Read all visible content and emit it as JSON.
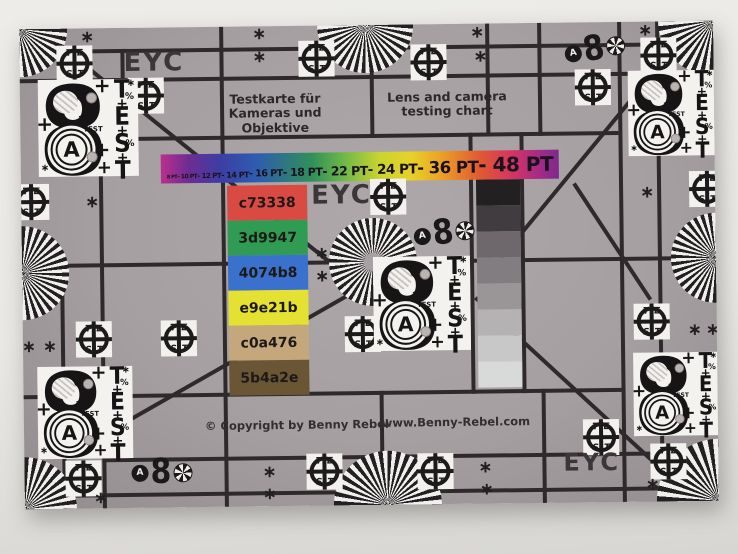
{
  "card": {
    "eyc_label": "EYC",
    "title_de_line1": "Testkarte für",
    "title_de_line2": "Kameras und Objektive",
    "title_en_line1": "Lens and camera",
    "title_en_line2": "testing chart",
    "copyright": "© Copyright by Benny Rebel",
    "website": "www.Benny-Rebel.com"
  },
  "pt_bar": {
    "tokens": [
      "8 PT",
      "- 10 PT",
      "- 12 PT",
      "- 14 PT",
      "- 16 PT",
      "- 18 PT",
      "- 22 PT",
      "- 24 PT",
      "- 36 PT",
      "- 48 PT"
    ]
  },
  "color_patches": [
    {
      "label": "c73338",
      "color": "#d94a43"
    },
    {
      "label": "3d9947",
      "color": "#2f9b53"
    },
    {
      "label": "4074b8",
      "color": "#3a71cc"
    },
    {
      "label": "e9e21b",
      "color": "#e4e133"
    },
    {
      "label": "c0a476",
      "color": "#c4a87c"
    },
    {
      "label": "5b4a2e",
      "color": "#6a5535"
    }
  ],
  "grayscale_steps": [
    "#232021",
    "#413c3f",
    "#6e686c",
    "#827d80",
    "#9a9698",
    "#b5b2b4",
    "#c9c8c9",
    "#d8dad9"
  ],
  "test_target": {
    "top": "TE",
    "bottom": "ST"
  },
  "block8": {
    "digit": "8",
    "letter": "A",
    "test_letters": [
      "T",
      "E",
      "S",
      "T"
    ],
    "test_small": "TEST",
    "percent": "%",
    "plus": "+",
    "arrows": "<<<",
    "asterisk": "∗"
  },
  "mini8": {
    "digit": "8",
    "letter": "A"
  },
  "glyphs": {
    "asterisk": "∗"
  },
  "colors": {
    "card_gray": "#a59fa1",
    "grid_line": "#2e2a2b",
    "block_white": "#f4f2ef",
    "wall": "#e9e8e4"
  }
}
